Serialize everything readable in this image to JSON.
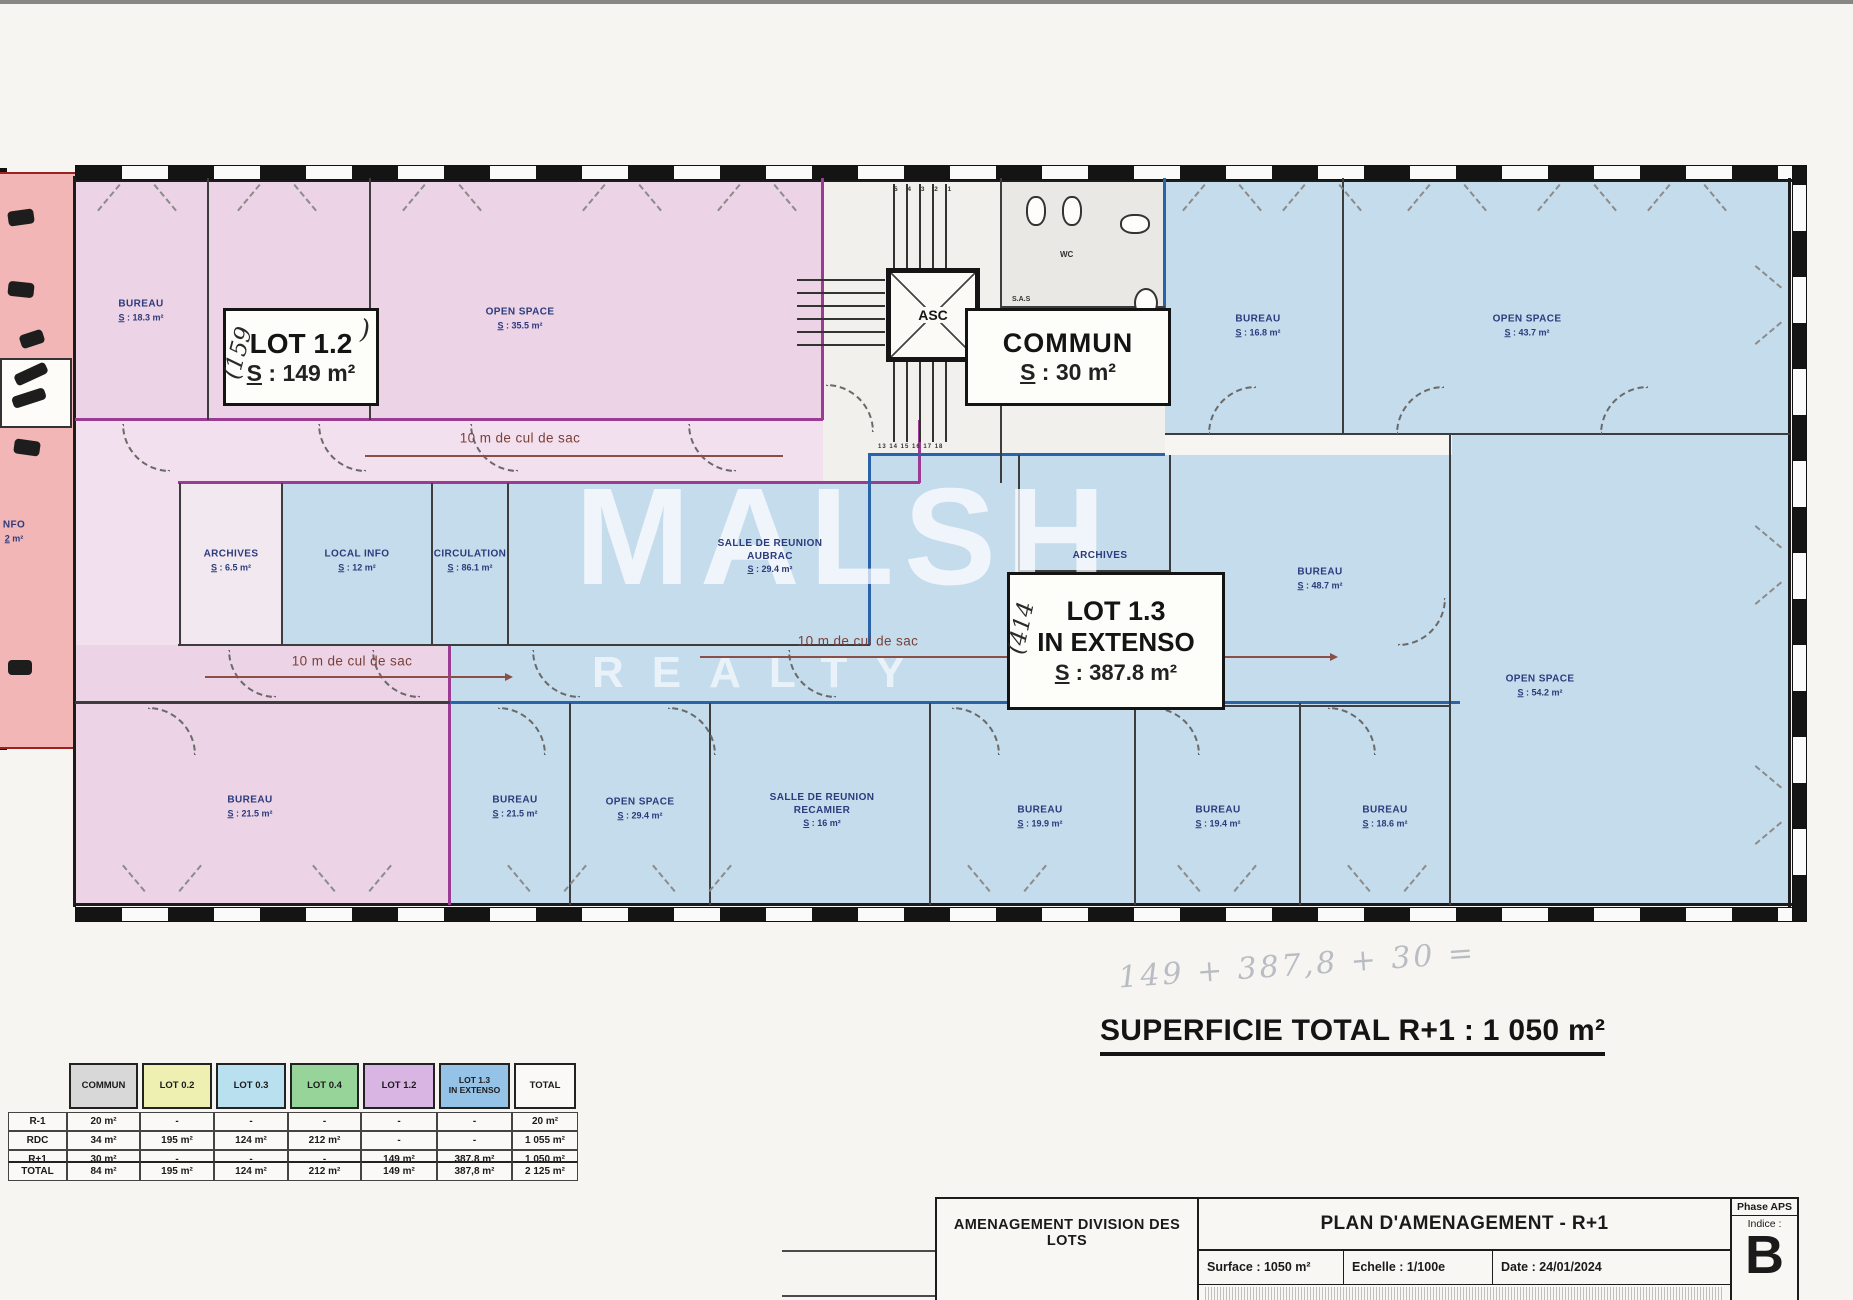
{
  "watermark": {
    "line1": "MALSH",
    "line2": "REALTY"
  },
  "plan": {
    "rooms": [
      {
        "name": "BUREAU",
        "area": "S : 18.3 m²"
      },
      {
        "name": "OPEN SPACE",
        "area": "S : 35.5 m²"
      },
      {
        "name": "BUREAU",
        "area": "S : 16.8 m²"
      },
      {
        "name": "OPEN SPACE",
        "area": "S : 43.7 m²"
      },
      {
        "name": "ARCHIVES",
        "area": "S : 6.5 m²"
      },
      {
        "name": "LOCAL INFO",
        "area": "S : 12 m²"
      },
      {
        "name": "CIRCULATION",
        "area": "S : 86.1 m²"
      },
      {
        "name": "SALLE DE REUNION\nAUBRAC",
        "area": "S : 29.4 m²"
      },
      {
        "name": "ARCHIVES",
        "area": ""
      },
      {
        "name": "BUREAU",
        "area": "S : 48.7 m²"
      },
      {
        "name": "OPEN SPACE",
        "area": "S : 54.2 m²"
      },
      {
        "name": "BUREAU",
        "area": "S : 21.5 m²"
      },
      {
        "name": "BUREAU",
        "area": "S : 21.5 m²"
      },
      {
        "name": "OPEN SPACE",
        "area": "S : 29.4 m²"
      },
      {
        "name": "SALLE DE REUNION\nRECAMIER",
        "area": "S : 16 m²"
      },
      {
        "name": "BUREAU",
        "area": "S : 19.9 m²"
      },
      {
        "name": "BUREAU",
        "area": "S : 19.4 m²"
      },
      {
        "name": "BUREAU",
        "area": "S : 18.6 m²"
      },
      {
        "name": "NFO",
        "area": "2 m²"
      }
    ],
    "lot12": {
      "line1": "LOT 1.2",
      "line2": "S : 149 m²"
    },
    "commun": {
      "line1": "COMMUN",
      "line2": "S : 30 m²"
    },
    "lot13": {
      "line1": "LOT 1.3",
      "line2": "IN EXTENSO",
      "line3": "S : 387.8 m²"
    },
    "culdesac": "10 m de cul de sac",
    "stairs": {
      "asc": "ASC",
      "sas": "S.A.S",
      "wc": "WC",
      "top_steps": "5 4 3 2 1",
      "bottom_steps": "13 14 15 16 17 18"
    }
  },
  "handwritten": {
    "lot12_note": "(159",
    "lot12_paren": ")",
    "lot13_note": "(414",
    "formula": "149 + 387,8 + 30 ="
  },
  "summary": {
    "superficie": "SUPERFICIE TOTAL R+1 : 1 050 m²"
  },
  "table": {
    "col_headers": [
      "",
      "COMMUN",
      "LOT 0.2",
      "LOT 0.3",
      "LOT 0.4",
      "LOT 1.2",
      "LOT 1.3\nIN EXTENSO",
      "TOTAL"
    ],
    "rows": [
      {
        "label": "R-1",
        "values": [
          "20 m²",
          "-",
          "-",
          "-",
          "-",
          "-",
          "20 m²"
        ]
      },
      {
        "label": "RDC",
        "values": [
          "34 m²",
          "195 m²",
          "124 m²",
          "212 m²",
          "-",
          "-",
          "1 055 m²"
        ]
      },
      {
        "label": "R+1",
        "values": [
          "30 m²",
          "-",
          "-",
          "-",
          "149 m²",
          "387,8 m²",
          "1 050 m²"
        ]
      },
      {
        "label": "TOTAL",
        "values": [
          "84 m²",
          "195 m²",
          "124 m²",
          "212 m²",
          "149 m²",
          "387,8 m²",
          "2 125 m²"
        ]
      }
    ]
  },
  "titleblock": {
    "left_title": "AMENAGEMENT DIVISION DES LOTS",
    "title": "PLAN D'AMENAGEMENT - R+1",
    "surface": "Surface : 1050 m²",
    "echelle": "Echelle : 1/100e",
    "date": "Date : 24/01/2024",
    "phase": "Phase APS",
    "indice_label": "Indice :",
    "indice": "B"
  },
  "colors": {
    "lot12_fill": "#ecd3e6",
    "lot13_fill": "#c5dcec",
    "salmon_fill": "#f3b6b6",
    "magenta_wall": "#9c3b94",
    "blue_wall": "#2a63a8",
    "hdr_commun": "#d8d8d8",
    "hdr_lot02": "#eef0b2",
    "hdr_lot03": "#b9e0ef",
    "hdr_lot04": "#97d49a",
    "hdr_lot12": "#d9b5e4",
    "hdr_lot13": "#95c3e8"
  }
}
